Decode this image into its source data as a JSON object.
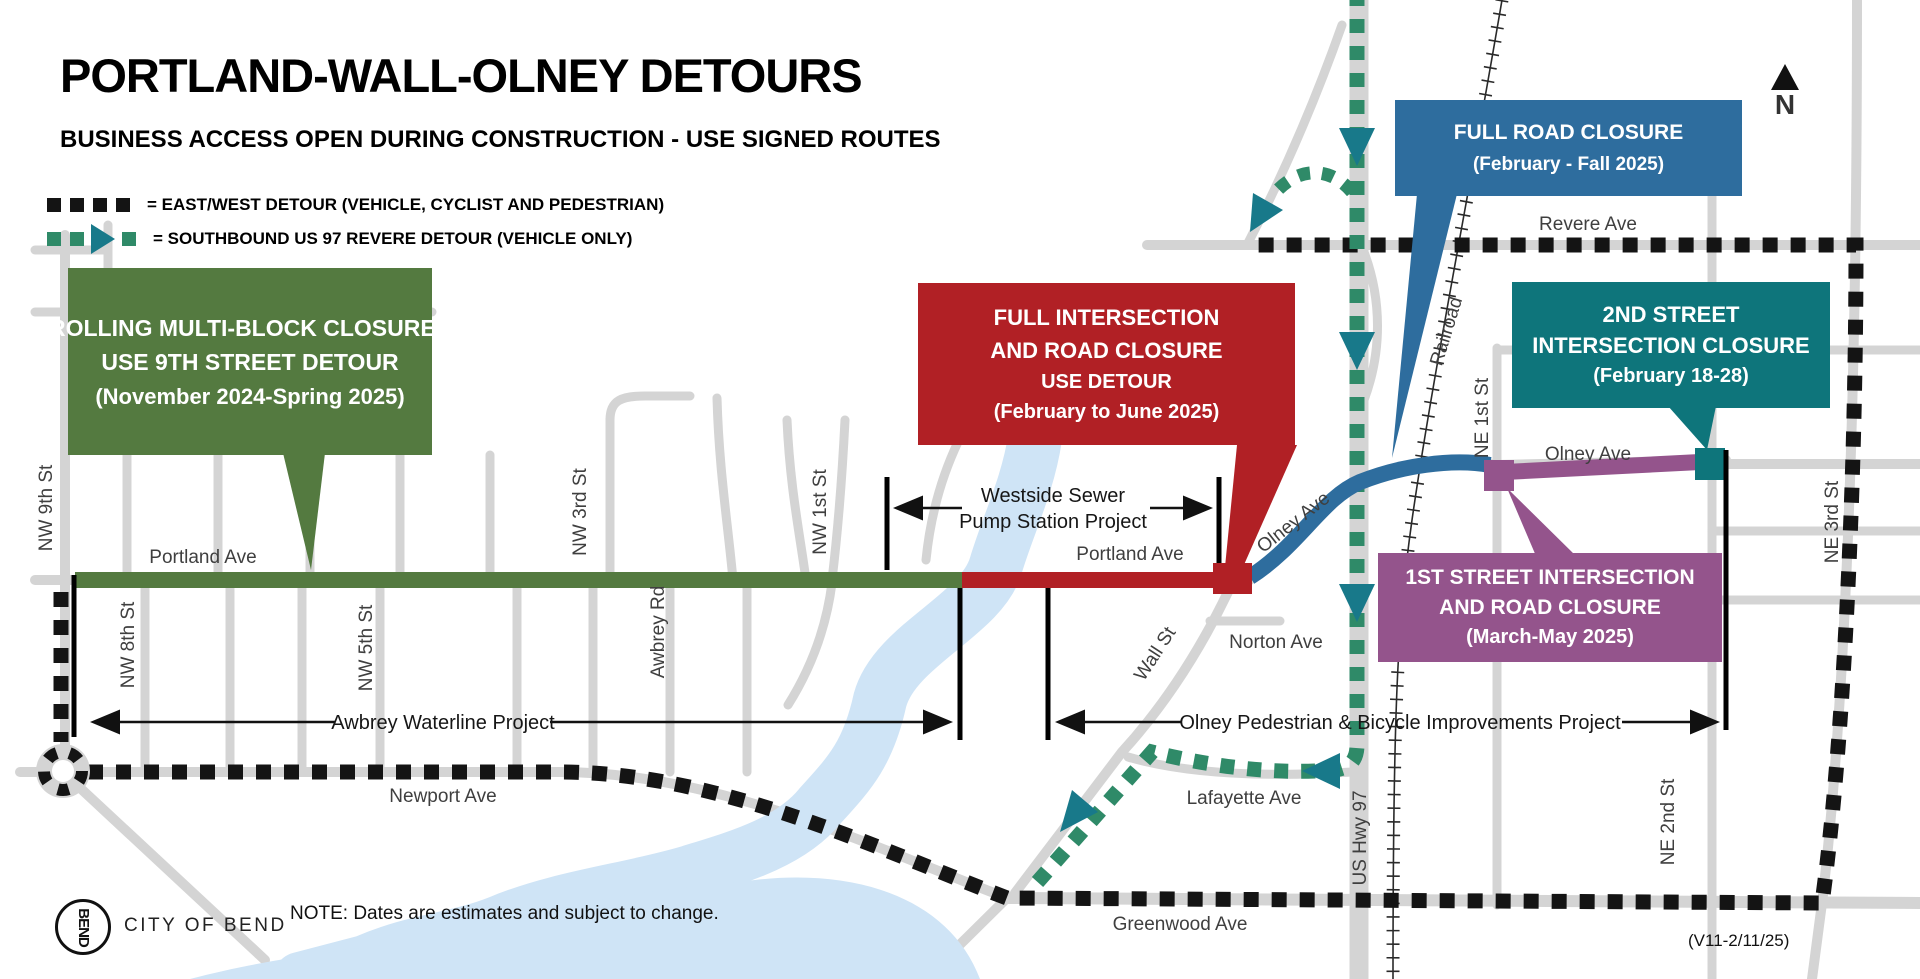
{
  "header": {
    "title": "PORTLAND-WALL-OLNEY DETOURS",
    "subtitle": "BUSINESS ACCESS OPEN DURING CONSTRUCTION - USE SIGNED ROUTES"
  },
  "legend": {
    "east_west_label": "= EAST/WEST DETOUR (VEHICLE, CYCLIST AND PEDESTRIAN)",
    "southbound_label": "= SOUTHBOUND US 97 REVERE DETOUR (VEHICLE ONLY)"
  },
  "callouts": {
    "rolling": {
      "color": "#547a40",
      "lines": [
        "ROLLING MULTI-BLOCK CLOSURES",
        "USE 9TH STREET DETOUR",
        "(November 2024-Spring 2025)"
      ]
    },
    "full_intersection": {
      "color": "#b12025",
      "lines": [
        "FULL INTERSECTION",
        "AND ROAD CLOSURE",
        "USE DETOUR",
        "(February to June 2025)"
      ]
    },
    "full_road": {
      "color": "#2e6d9e",
      "lines": [
        "FULL ROAD CLOSURE",
        "(February - Fall 2025)"
      ]
    },
    "second_street": {
      "color": "#0e757b",
      "lines": [
        "2ND STREET",
        "INTERSECTION CLOSURE",
        "(February 18-28)"
      ]
    },
    "first_street": {
      "color": "#94548c",
      "lines": [
        "1ST STREET INTERSECTION",
        "AND ROAD CLOSURE",
        "(March-May 2025)"
      ]
    }
  },
  "streets": {
    "nw_9th": "NW 9th St",
    "nw_8th": "NW 8th St",
    "nw_5th": "NW 5th St",
    "nw_3rd": "NW 3rd St",
    "nw_1st": "NW 1st St",
    "awbrey_rd": "Awbrey Rd",
    "portland_w": "Portland Ave",
    "portland_e": "Portland Ave",
    "newport": "Newport Ave",
    "norton": "Norton Ave",
    "lafayette": "Lafayette Ave",
    "wall": "Wall St",
    "olney_diag": "Olney Ave",
    "olney_e": "Olney Ave",
    "us_hwy_97": "US Hwy 97",
    "railroad": "Railroad",
    "ne_1st": "NE 1st St",
    "ne_2nd": "NE 2nd St",
    "ne_3rd": "NE 3rd St",
    "revere": "Revere Ave",
    "greenwood": "Greenwood Ave"
  },
  "projects": {
    "westside_line1": "Westside Sewer",
    "westside_line2": "Pump Station Project",
    "awbrey": "Awbrey Waterline Project",
    "olney": "Olney Pedestrian & Bicycle Improvements Project"
  },
  "footer": {
    "note": "NOTE: Dates are estimates and subject to change.",
    "version": "(V11-2/11/25)",
    "org": "CITY OF BEND",
    "logo": "BEND"
  },
  "compass": {
    "label": "N"
  },
  "colors": {
    "detour_black": "#141414",
    "detour_teal_dash": "#2f8a68",
    "detour_teal_arrow": "#18798a",
    "closure_green": "#547a40",
    "closure_red": "#b12025",
    "closure_blue": "#2e6d9e",
    "closure_teal": "#0e757b",
    "closure_purple": "#94548c",
    "road_gray": "#d4d4d4",
    "river_blue": "#cfe4f6"
  }
}
